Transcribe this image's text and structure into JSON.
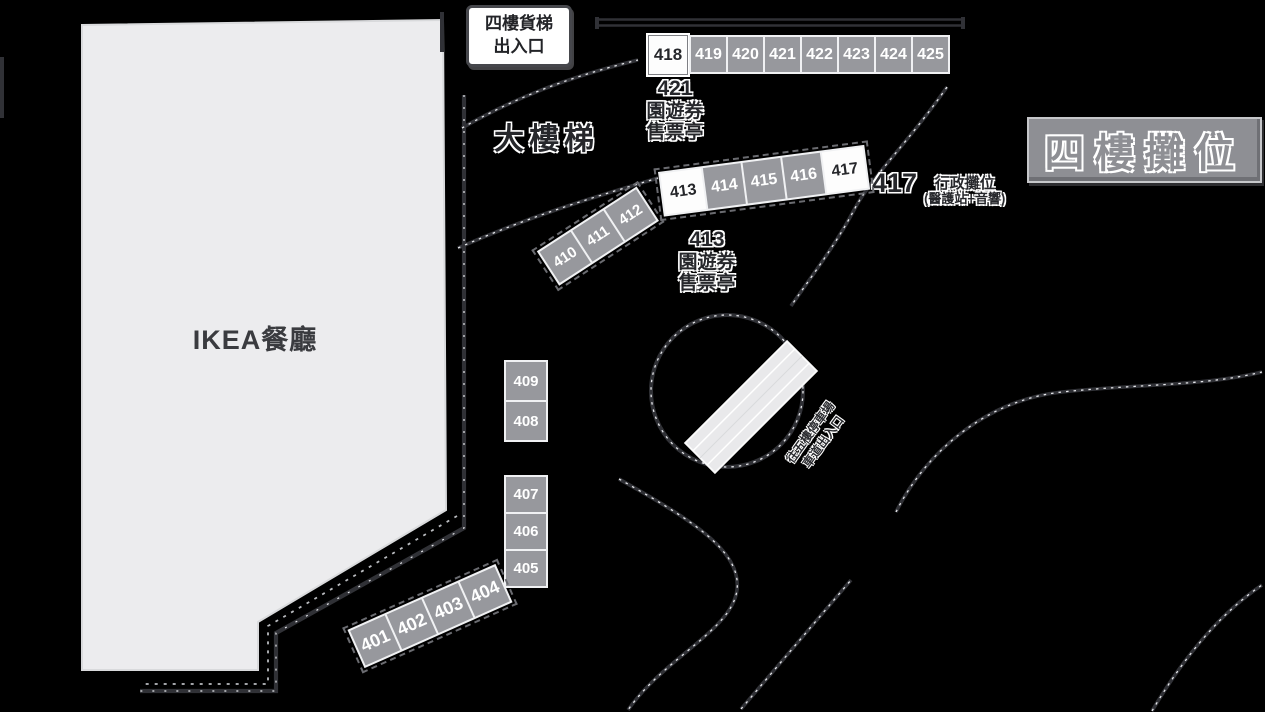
{
  "signs": {
    "freight_elevator": {
      "line1": "四樓貨梯",
      "line2": "出入口"
    },
    "grand_staircase": "大樓梯",
    "floor_booths": "四樓攤位",
    "ikea_restaurant": "IKEA餐廳"
  },
  "kiosks": {
    "k421": {
      "number": "421",
      "line1": "園遊券",
      "line2": "售票亭"
    },
    "k413": {
      "number": "413",
      "line1": "園遊券",
      "line2": "售票亭"
    },
    "k417": {
      "number": "417",
      "title": "行政攤位",
      "subtitle": "(醫護站+音響)"
    }
  },
  "ramp_label": {
    "line1": "往五樓停車場",
    "line2": "車道出入口"
  },
  "booths": {
    "top_highlight": "418",
    "top_row": [
      "419",
      "420",
      "421",
      "422",
      "423",
      "424",
      "425"
    ],
    "mid_left_row": [
      "410",
      "411",
      "412"
    ],
    "mid_highlight_left": "413",
    "mid_row": [
      "414",
      "415",
      "416"
    ],
    "mid_highlight_right": "417",
    "left_upper_stack": [
      "409",
      "408"
    ],
    "left_lower_stack": [
      "407",
      "406",
      "405"
    ],
    "bottom_row": [
      "401",
      "402",
      "403",
      "404"
    ]
  },
  "colors": {
    "background": "#000000",
    "booth_fill": "#97989d",
    "booth_text": "#ffffff",
    "highlight_fill": "#fdfdfd",
    "highlight_text": "#26272b",
    "area_fill": "#ececee",
    "sign_fill": "#8e8f94",
    "line": "#303136",
    "label_text": "#26272b"
  }
}
